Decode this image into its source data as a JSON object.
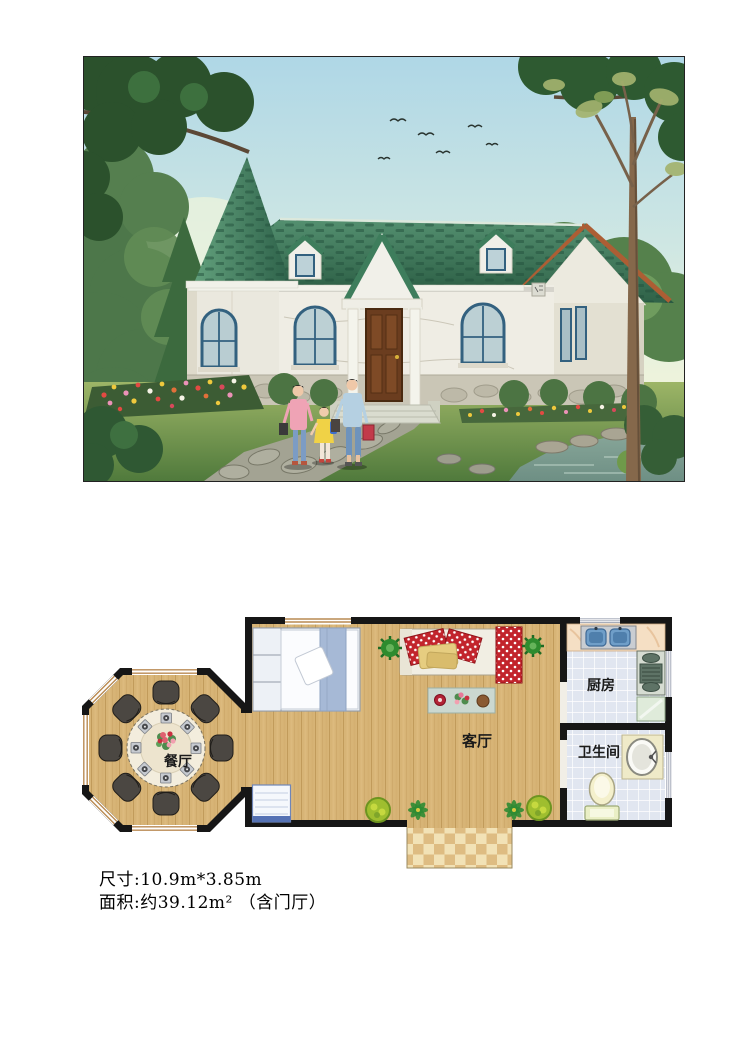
{
  "page": {
    "background": "#ffffff"
  },
  "photo": {
    "content": "exterior rendering: small cottage, green shingle roof with conical turret, marble walls, arched blue windows, garden path, pond, three people",
    "colors": {
      "roof_green": "#3E7D5C",
      "wall_white": "#EFEDE4",
      "door_brown": "#6B3D1F",
      "window_frame_blue": "#33617F",
      "sky_blue": "#AFD7E6"
    }
  },
  "floor_plan": {
    "rooms": [
      {
        "id": "dining",
        "label": "餐厅"
      },
      {
        "id": "living",
        "label": "客厅"
      },
      {
        "id": "kitchen",
        "label": "厨房"
      },
      {
        "id": "bathroom",
        "label": "卫生间"
      }
    ],
    "colors": {
      "wall": "#161616",
      "wood_floor": "#D7B476",
      "tile_floor": "#E1E6F0",
      "porch_tile_light": "#F2E2B6",
      "porch_tile_dark": "#DEBC82",
      "chair": "#4B4742",
      "sofa_cushion_red": "#C2242C"
    }
  },
  "caption": {
    "line1": "尺寸:10.9m*3.85m",
    "line2": "面积:约39.12m² （含门厅）"
  }
}
